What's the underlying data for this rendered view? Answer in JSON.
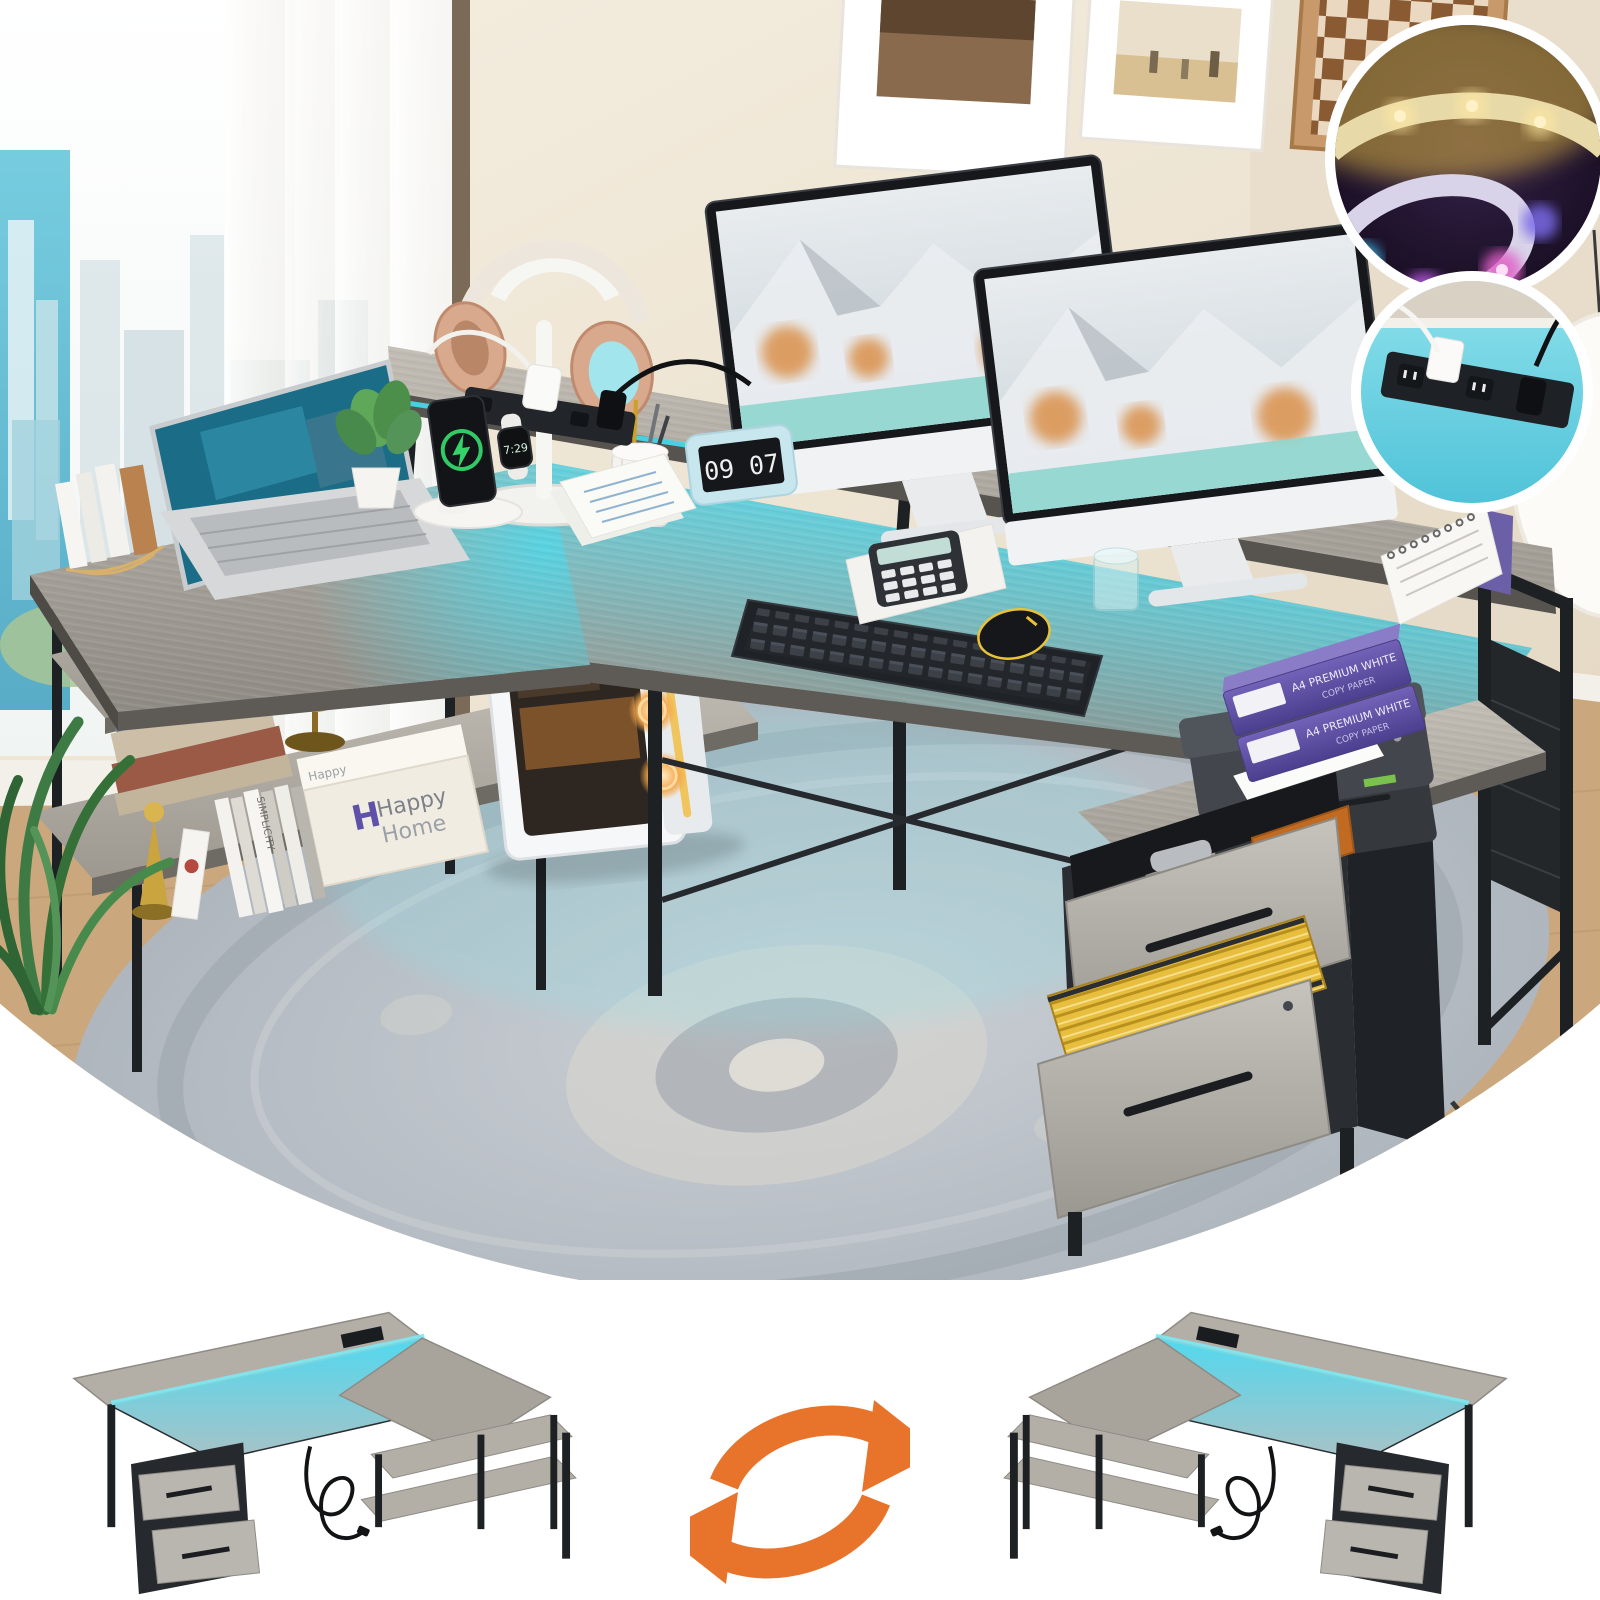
{
  "product_scene": {
    "clock": {
      "time": "09 07"
    },
    "smartwatch": {
      "time": "7:29"
    },
    "storage_box": {
      "brand_line1": "Happy",
      "brand_line2": "Home"
    },
    "paper_ream": {
      "label_line1": "A4 PREMIUM WHITE",
      "label_line2": "COPY PAPER"
    },
    "book_spine_title": "SIMPLICITY"
  },
  "icons": {
    "swap_arrows": "swap-arrows-icon",
    "charging_bolt": "lightning-bolt-icon"
  },
  "colors": {
    "led_glow": "#45DEF2",
    "swap_arrow_orange": "#E8732B",
    "ream_purple": "#5B4C9C",
    "hanging_files_yellow": "#E8BE3F",
    "folder_orange": "#C06A22",
    "charge_ring_green": "#35D46A",
    "desk_wood_grey": "#A8A49C",
    "metal_frame_black": "#1E2124"
  }
}
